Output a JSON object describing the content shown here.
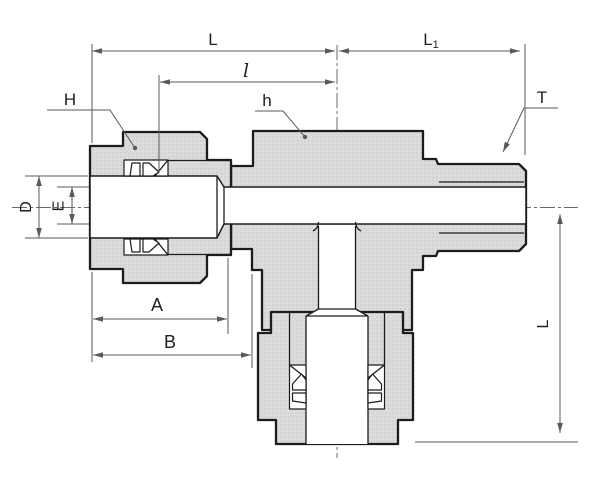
{
  "drawing": {
    "labels": {
      "overall_length": "L",
      "male_end_length": {
        "main": "L",
        "sub": "1"
      },
      "tube_insertion": "l",
      "nut_hex_size": "H",
      "body_hex_size": "h",
      "thread_size": "T",
      "tube_hole_dia": "D",
      "bore_dia": "E",
      "dim_a": "A",
      "dim_b": "B",
      "branch_length": "L"
    },
    "colors": {
      "outline": "#1c1c1c",
      "metal": "#dcdcdc",
      "metal_dot": "#b9b9b9",
      "dim_line": "#5a5a5a",
      "label": "#1e1e1e",
      "background": "#ffffff"
    }
  }
}
